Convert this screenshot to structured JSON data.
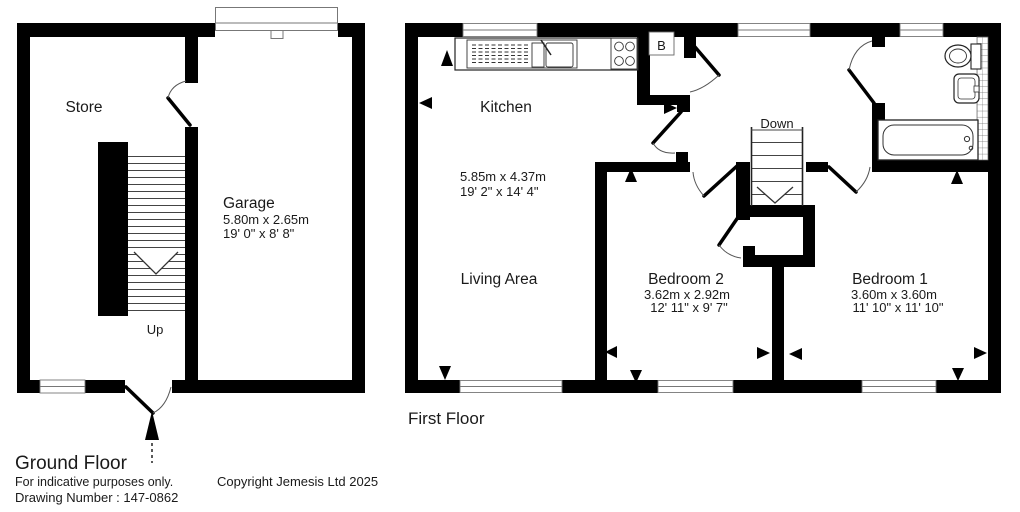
{
  "ground_floor": {
    "title": "Ground Floor",
    "store_label": "Store",
    "garage_label": "Garage",
    "garage_dim_metric": "5.80m x 2.65m",
    "garage_dim_imperial": "19' 0\" x 8' 8\"",
    "stairs_label": "Up"
  },
  "first_floor": {
    "title": "First Floor",
    "kitchen_label": "Kitchen",
    "kitchen_dim_metric": "5.85m x 4.37m",
    "kitchen_dim_imperial": "19' 2\" x 14' 4\"",
    "living_label": "Living Area",
    "bedroom2_label": "Bedroom 2",
    "bedroom2_dim_metric": "3.62m x 2.92m",
    "bedroom2_dim_imperial": "12' 11\" x 9' 7\"",
    "bedroom1_label": "Bedroom 1",
    "bedroom1_dim_metric": "3.60m x 3.60m",
    "bedroom1_dim_imperial": "11' 10\" x 11' 10\"",
    "boiler_label": "B",
    "stairs_label": "Down"
  },
  "footer": {
    "disclaimer": "For indicative purposes only.",
    "drawing_number": "Drawing Number : 147-0862",
    "copyright": "Copyright Jemesis Ltd 2025"
  },
  "colors": {
    "wall": "#000000",
    "thin_line": "#777777",
    "text": "#1a1a1a"
  }
}
